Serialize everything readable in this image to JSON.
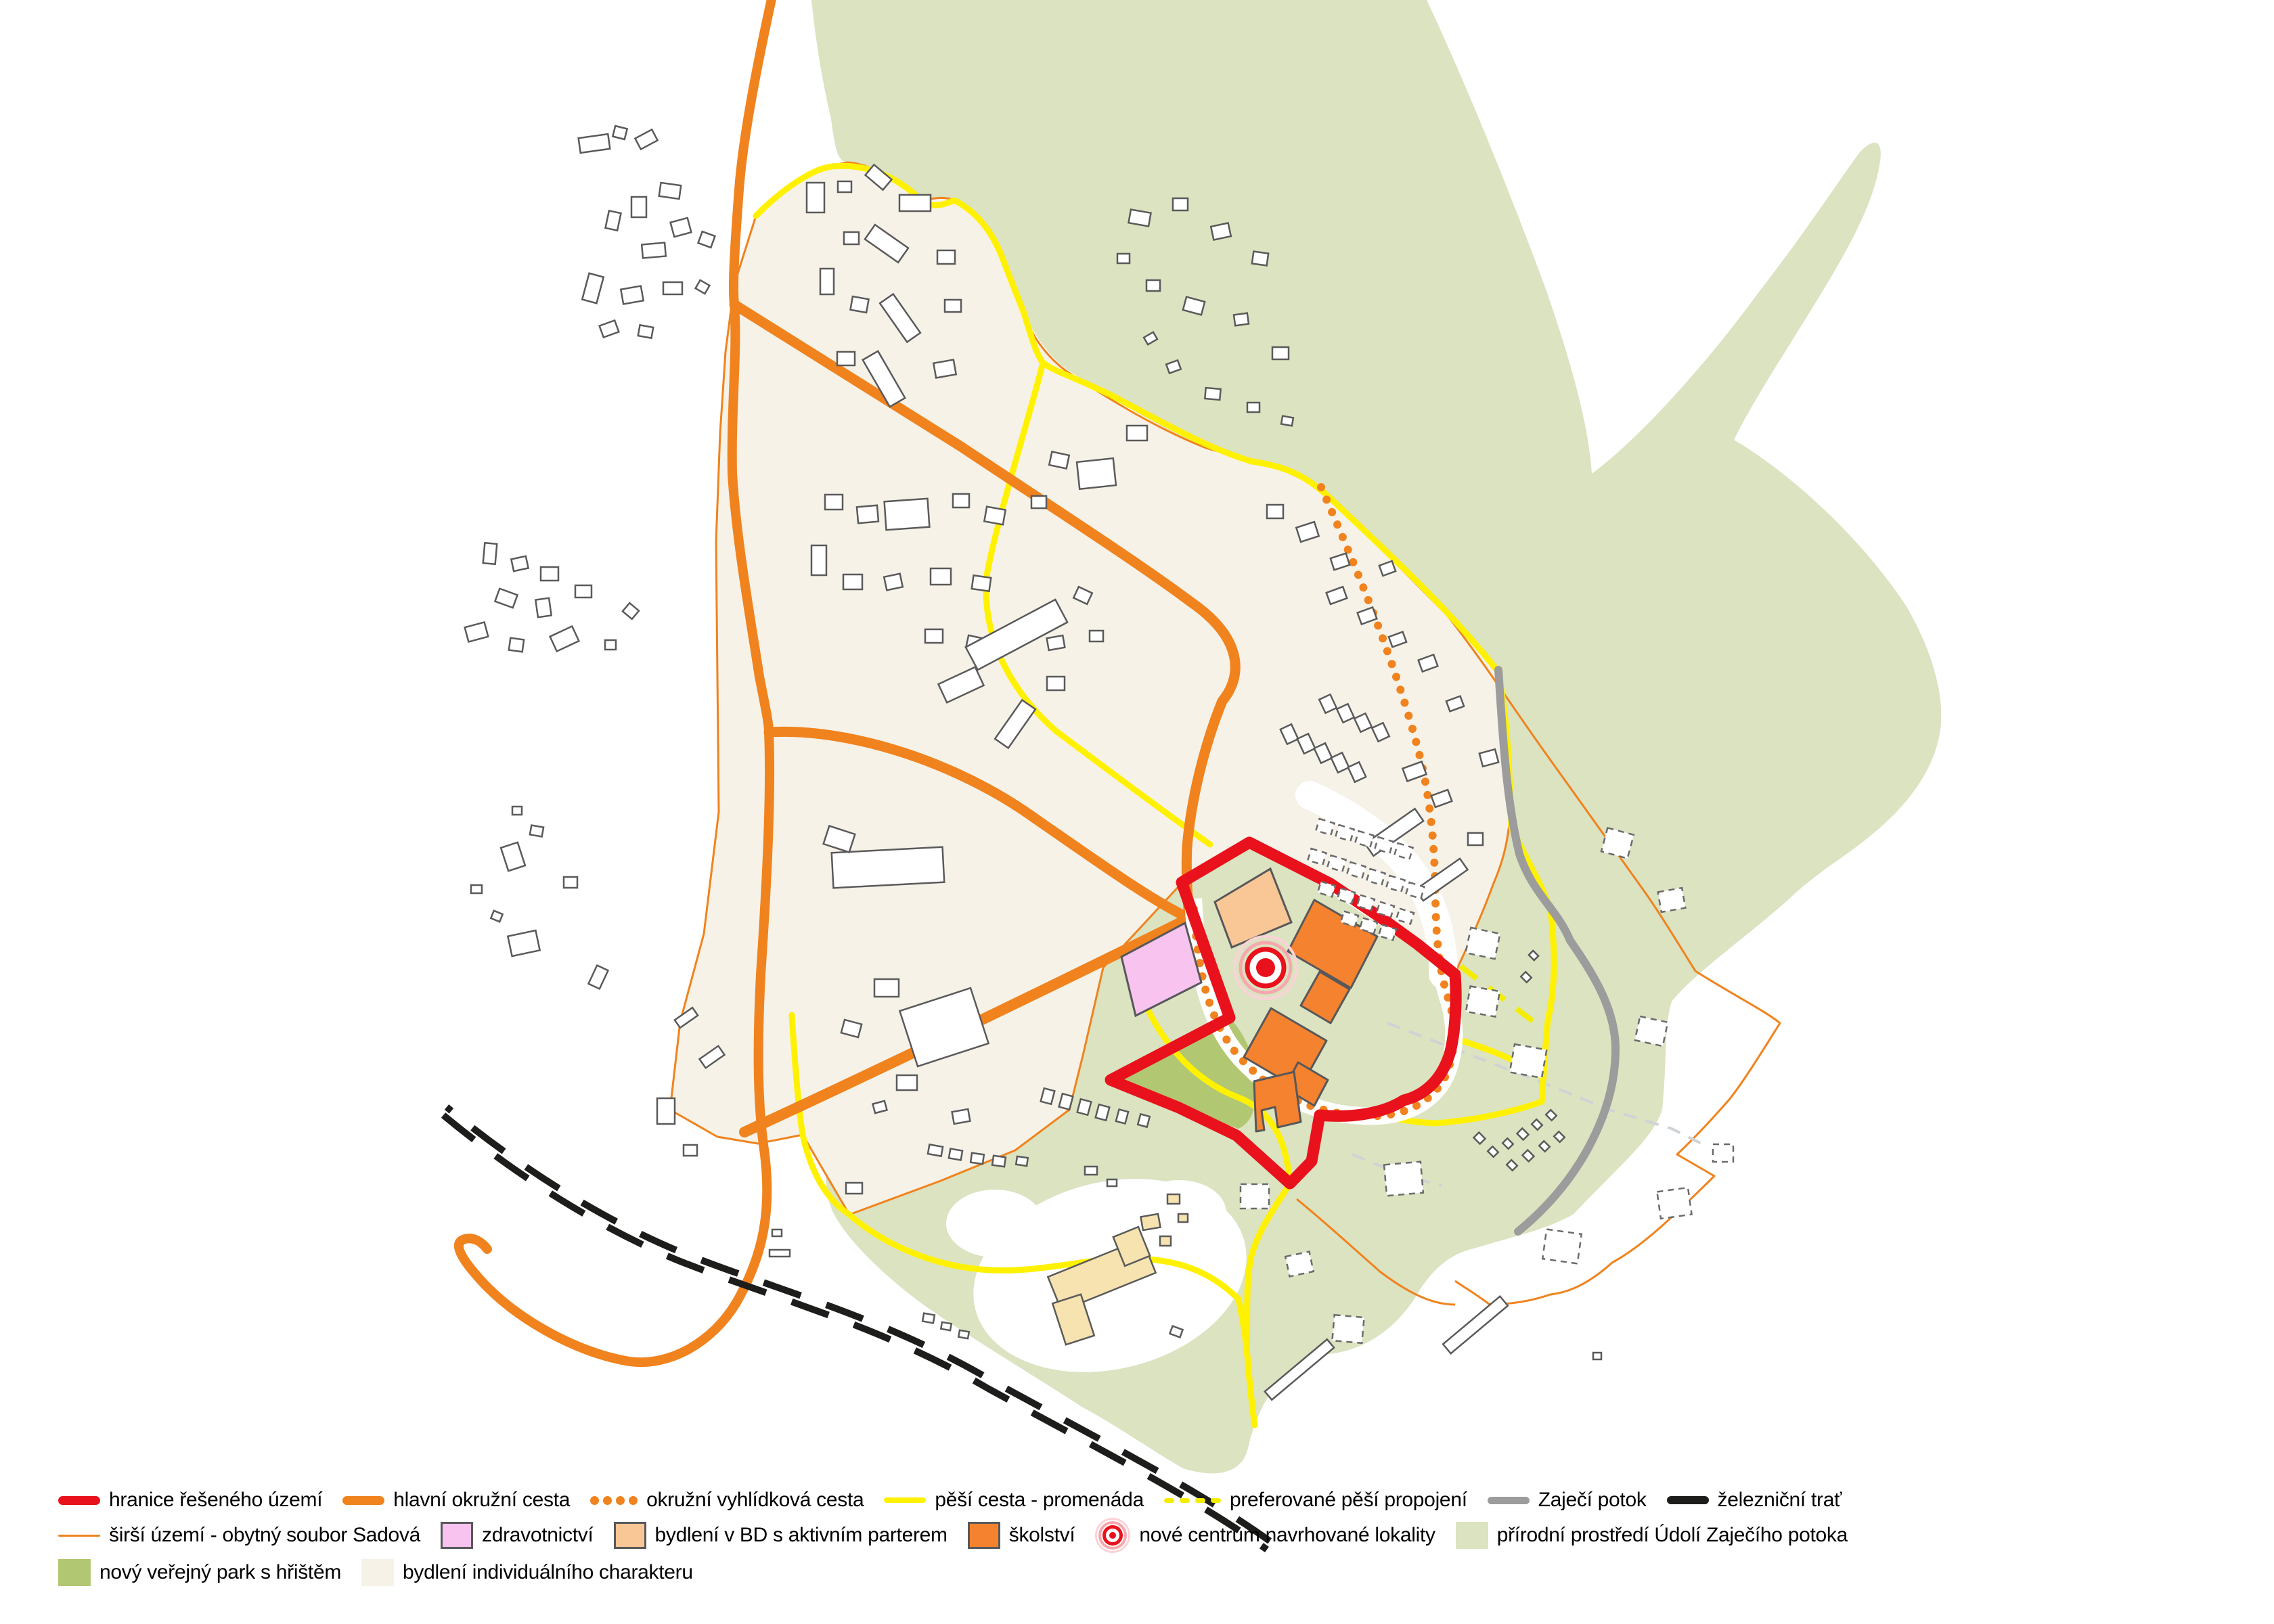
{
  "legend": {
    "rows": [
      [
        {
          "swatch": "line",
          "color": "#e8111c",
          "weight": 13,
          "label": "hranice řešeného území"
        },
        {
          "swatch": "line",
          "color": "#f0831e",
          "weight": 13,
          "label": "hlavní okružní cesta"
        },
        {
          "swatch": "dots",
          "color": "#f0831e",
          "label": "okružní vyhlídková cesta"
        },
        {
          "swatch": "line",
          "color": "#fff100",
          "weight": 8,
          "label": "pěší cesta - promenáda"
        },
        {
          "swatch": "dashes",
          "color": "#f5ed00",
          "label": "preferované pěší propojení"
        },
        {
          "swatch": "line",
          "color": "#9c9c9c",
          "weight": 11,
          "label": "Zaječí potok"
        },
        {
          "swatch": "line",
          "color": "#1d1d1b",
          "weight": 12,
          "label": "železniční trať"
        }
      ],
      [
        {
          "swatch": "line",
          "color": "#f0831e",
          "weight": 3,
          "label": "širší území - obytný soubor Sadová"
        },
        {
          "swatch": "box",
          "color": "#f8c3ee",
          "border": "#58585a",
          "label": "zdravotnictví"
        },
        {
          "swatch": "box",
          "color": "#f9c795",
          "border": "#58585a",
          "label": "bydlení v BD s aktivním parterem"
        },
        {
          "swatch": "box",
          "color": "#f5822e",
          "border": "#58585a",
          "label": "školství"
        },
        {
          "swatch": "target",
          "label": "nové centrum navrhované lokality"
        },
        {
          "swatch": "box",
          "color": "#dbe3c1",
          "border": "",
          "label": "přírodní prostředí Údolí Zaječího potoka"
        }
      ],
      [
        {
          "swatch": "box",
          "color": "#b2c772",
          "border": "",
          "label": "nový veřejný park s hřištěm"
        },
        {
          "swatch": "box",
          "color": "#f6f2e8",
          "border": "",
          "label": "bydlení individuálního charakteru"
        }
      ]
    ]
  },
  "map_colors": {
    "boundary_red": "#e8111c",
    "main_road_orange": "#f0831e",
    "promenade_yellow": "#fff100",
    "stream_gray": "#9c9c9c",
    "railway_black": "#1d1d1b",
    "health_pink": "#f8c3ee",
    "housing_bd_peach": "#f9c795",
    "school_orange": "#f5822e",
    "park_green": "#b2c772",
    "nature_green": "#dbe3c1",
    "individual_housing_cream": "#f6f2e8"
  }
}
